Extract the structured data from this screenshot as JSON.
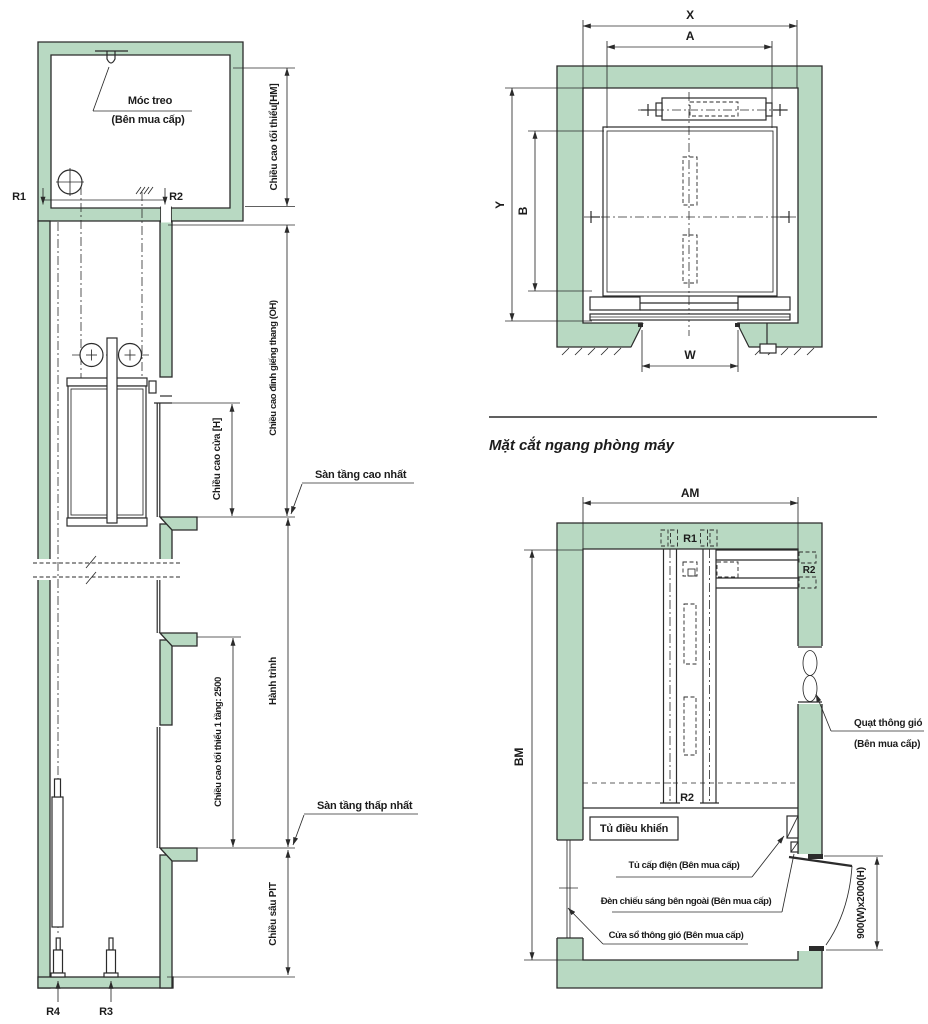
{
  "colors": {
    "wall_fill": "#b8d9c2",
    "line": "#2b2b2b"
  },
  "shaft": {
    "hook_label": "Móc treo",
    "hook_sub": "(Bên mua cấp)",
    "r1": "R1",
    "r2": "R2",
    "r3": "R3",
    "r4": "R4",
    "dim_hm": "Chiều cao tối thiểu[HM]",
    "dim_oh": "Chiều cao đỉnh giếng thang (OH)",
    "dim_door": "Chiều cao cửa [H]",
    "top_floor": "Sàn tầng cao nhất",
    "dim_travel": "Hành trình",
    "dim_floor": "Chiều cao tối thiểu 1 tầng: 2500",
    "bottom_floor": "Sàn tầng thấp nhất",
    "dim_pit": "Chiều sâu PIT"
  },
  "hoistway_plan": {
    "dim_x": "X",
    "dim_a": "A",
    "dim_y": "Y",
    "dim_b": "B",
    "dim_w": "W",
    "caption": "Mặt cắt ngang phòng máy"
  },
  "machine_room": {
    "dim_am": "AM",
    "dim_bm": "BM",
    "r1": "R1",
    "r2_top": "R2",
    "r2_bottom": "R2",
    "control_panel": "Tủ điều khiển",
    "fan_label": "Quạt thông gió",
    "fan_sub": "(Bên mua cấp)",
    "power_cabinet": "Tủ cấp điện (Bên mua cấp)",
    "outdoor_light": "Đèn chiếu sáng bên ngoài (Bên mua cấp)",
    "vent_window": "Cửa sổ thông gió (Bên mua cấp)",
    "door_size": "900(W)x2000(H)"
  }
}
